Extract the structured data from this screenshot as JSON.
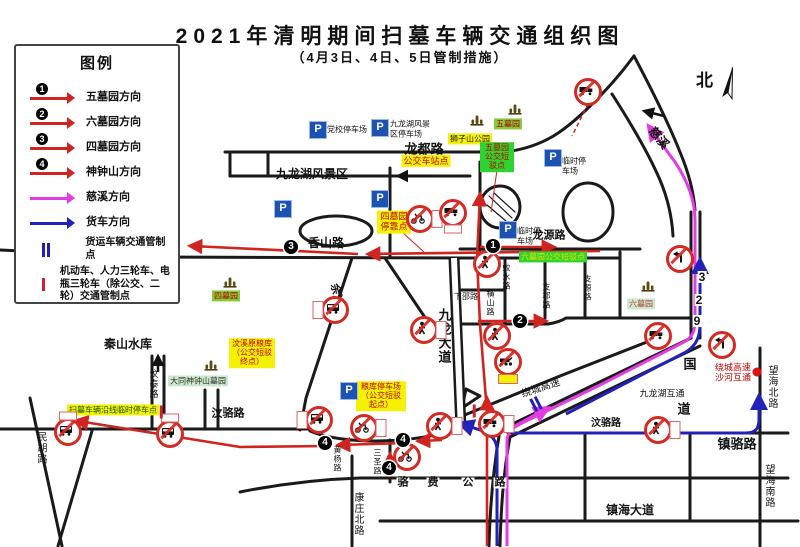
{
  "title": "2021年清明期间扫墓车辆交通组织图",
  "subtitle": "（4月3日、4日、5日管制措施）",
  "compass_label": "北",
  "colors": {
    "route_red": "#cf2420",
    "route_magenta": "#e23ce2",
    "route_blue": "#2222b8",
    "parking_blue": "#1c53b0",
    "highlight_yellow": "#f4f104",
    "highlight_green": "#2fd32f"
  },
  "legend": {
    "title": "图例",
    "routes": [
      {
        "num": "1",
        "label": "五墓园方向",
        "color": "#cf2420"
      },
      {
        "num": "2",
        "label": "六墓园方向",
        "color": "#cf2420"
      },
      {
        "num": "3",
        "label": "四墓园方向",
        "color": "#cf2420"
      },
      {
        "num": "4",
        "label": "神钟山方向",
        "color": "#cf2420"
      },
      {
        "num": "",
        "label": "慈溪方向",
        "color": "#e23ce2"
      },
      {
        "num": "",
        "label": "货车方向",
        "color": "#2222b8"
      }
    ],
    "points": [
      {
        "icon": "blue-double-bar",
        "label": "货运车辆交通管制点"
      },
      {
        "icon": "red-bar",
        "label": "机动车、人力三轮车、电瓶三轮车（除公交、二轮）交通管制点"
      }
    ]
  },
  "map": {
    "road_labels": [
      {
        "t": "龙都路",
        "x": 424,
        "y": 149,
        "s": 13,
        "b": 1
      },
      {
        "t": "九龙湖风景区",
        "x": 312,
        "y": 174,
        "s": 12,
        "b": 1
      },
      {
        "t": "香山路",
        "x": 326,
        "y": 243,
        "s": 12,
        "b": 1
      },
      {
        "t": "龙源路",
        "x": 549,
        "y": 236,
        "s": 11,
        "b": 1
      },
      {
        "t": "余汶线",
        "x": 337,
        "y": 300,
        "s": 11,
        "b": 1,
        "rot": 78
      },
      {
        "t": "九龙大道",
        "x": 444,
        "y": 336,
        "s": 13,
        "b": 1,
        "v": 1
      },
      {
        "t": "秦山水库",
        "x": 128,
        "y": 344,
        "s": 12,
        "b": 1
      },
      {
        "t": "汶泰路",
        "x": 153,
        "y": 384,
        "s": 9,
        "v": 1
      },
      {
        "t": "民胡路",
        "x": 40,
        "y": 448,
        "s": 10,
        "v": 1
      },
      {
        "t": "汶骆路",
        "x": 228,
        "y": 414,
        "s": 11,
        "b": 1
      },
      {
        "t": "汶骆路",
        "x": 606,
        "y": 424,
        "s": 10,
        "b": 1
      },
      {
        "t": "镇骆路",
        "x": 737,
        "y": 444,
        "s": 13,
        "b": 1
      },
      {
        "t": "望海北路",
        "x": 771,
        "y": 387,
        "s": 10,
        "v": 1
      },
      {
        "t": "望海南路",
        "x": 768,
        "y": 486,
        "s": 10,
        "v": 1
      },
      {
        "t": "镇海大道",
        "x": 630,
        "y": 510,
        "s": 12,
        "b": 1
      },
      {
        "t": "康庄北路",
        "x": 357,
        "y": 514,
        "s": 10,
        "v": 1
      },
      {
        "t": "绕城高速",
        "x": 541,
        "y": 389,
        "s": 10,
        "rot": -18
      },
      {
        "t": "九龙湖互通",
        "x": 662,
        "y": 394,
        "s": 9
      },
      {
        "t": "慈溪",
        "x": 659,
        "y": 138,
        "s": 12,
        "b": 1,
        "rot": 50
      },
      {
        "t": "下邵路",
        "x": 466,
        "y": 297,
        "s": 8
      },
      {
        "t": "蛟水路",
        "x": 506,
        "y": 277,
        "s": 8,
        "v": 1
      },
      {
        "t": "支源路",
        "x": 587,
        "y": 288,
        "s": 8,
        "v": 1
      },
      {
        "t": "支郡路",
        "x": 546,
        "y": 296,
        "s": 8,
        "v": 1
      },
      {
        "t": "横山路",
        "x": 490,
        "y": 303,
        "s": 8,
        "v": 1
      },
      {
        "t": "三圣路",
        "x": 377,
        "y": 462,
        "s": 8,
        "v": 1
      },
      {
        "t": "黄杨路",
        "x": 337,
        "y": 459,
        "s": 8,
        "v": 1
      },
      {
        "t": "3",
        "x": 702,
        "y": 277,
        "s": 12,
        "b": 1,
        "bg": 1
      },
      {
        "t": "2",
        "x": 699,
        "y": 300,
        "s": 12,
        "b": 1,
        "bg": 1
      },
      {
        "t": "9",
        "x": 697,
        "y": 321,
        "s": 12,
        "b": 1,
        "bg": 1
      },
      {
        "t": "国",
        "x": 690,
        "y": 364,
        "s": 13,
        "b": 1,
        "bg": 1
      },
      {
        "t": "道",
        "x": 684,
        "y": 409,
        "s": 13,
        "b": 1,
        "bg": 1
      },
      {
        "t": "骆",
        "x": 403,
        "y": 483,
        "s": 11,
        "b": 1,
        "bg": 1
      },
      {
        "t": "费",
        "x": 433,
        "y": 483,
        "s": 11,
        "b": 1,
        "bg": 1
      },
      {
        "t": "公",
        "x": 468,
        "y": 483,
        "s": 11,
        "b": 1,
        "bg": 1
      },
      {
        "t": "路",
        "x": 500,
        "y": 483,
        "s": 11,
        "b": 1,
        "bg": 1
      }
    ],
    "area_labels": [
      {
        "t": "公交车站点",
        "x": 426,
        "y": 161,
        "bg": "#f4f104",
        "c": "#c00000",
        "s": 9
      },
      {
        "t": "狮子山公园",
        "x": 470,
        "y": 139,
        "bg": "#f4f104",
        "c": "#222222",
        "s": 8
      },
      {
        "t": "五墓园",
        "x": 508,
        "y": 124,
        "bg": "#86cc3a",
        "c": "#b00000",
        "s": 8
      },
      {
        "t": "四墓园",
        "x": 226,
        "y": 296,
        "bg": "#86cc3a",
        "c": "#b00000",
        "s": 8
      },
      {
        "t": "六墓园",
        "x": 641,
        "y": 304,
        "bg": "#cde9cd",
        "c": "#b04040",
        "s": 8
      },
      {
        "t": "大同神钟山墓园",
        "x": 198,
        "y": 381,
        "bg": "#cde9cd",
        "c": "#333333",
        "s": 8
      },
      {
        "t": "五墓园公交短驳点",
        "x": 497,
        "y": 157,
        "bg": "#2fd32f",
        "c": "#c00000",
        "s": 8,
        "w": 30
      },
      {
        "t": "六墓园公交短驳点",
        "x": 553,
        "y": 257,
        "bg": "#2fd32f",
        "c": "#e8e000",
        "s": 8
      },
      {
        "t": "四墓园停靠点",
        "x": 394,
        "y": 222,
        "bg": "#f4f104",
        "c": "#c00000",
        "s": 9,
        "w": 30
      },
      {
        "t": "汶溪原粮库（公交短驳终点）",
        "x": 252,
        "y": 353,
        "bg": "#f4f104",
        "c": "#c00000",
        "s": 8,
        "w": 42
      },
      {
        "t": "粮库停车场（公交短驳起点）",
        "x": 381,
        "y": 396,
        "bg": "#f4f104",
        "c": "#c00000",
        "s": 8,
        "w": 46
      },
      {
        "t": "扫墓车辆沿线临时停车点",
        "x": 113,
        "y": 410,
        "bg": "#f4f104",
        "c": "#155515",
        "s": 8
      },
      {
        "t": "绕城高速沙河互通",
        "x": 733,
        "y": 373,
        "bg": "",
        "c": "#c00000",
        "s": 9,
        "w": 40
      }
    ],
    "parkings": [
      {
        "x": 318,
        "y": 130,
        "lt": "党校停车场",
        "lx": 352,
        "ly": 130,
        "lw": 50
      },
      {
        "x": 380,
        "y": 128,
        "lt": "九龙湖风景\n区停车场",
        "lx": 414,
        "ly": 129,
        "lw": 48
      },
      {
        "x": 380,
        "y": 199,
        "lt": "",
        "lx": 0,
        "ly": 0,
        "lw": 0
      },
      {
        "x": 283,
        "y": 209,
        "lt": "",
        "lx": 0,
        "ly": 0,
        "lw": 0
      },
      {
        "x": 508,
        "y": 230,
        "lt": "临时停\n车场",
        "lx": 530,
        "ly": 236,
        "lw": 26
      },
      {
        "x": 553,
        "y": 158,
        "lt": "临时停\n车场",
        "lx": 575,
        "ly": 166,
        "lw": 26
      },
      {
        "x": 349,
        "y": 391,
        "lt": "",
        "lx": 0,
        "ly": 0,
        "lw": 0
      }
    ],
    "pagodas": [
      {
        "x": 515,
        "y": 111
      },
      {
        "x": 477,
        "y": 122
      },
      {
        "x": 648,
        "y": 288
      },
      {
        "x": 230,
        "y": 284
      },
      {
        "x": 211,
        "y": 367
      }
    ],
    "signs": [
      {
        "x": 588,
        "y": 92,
        "g": "truck"
      },
      {
        "x": 680,
        "y": 259,
        "g": "turn"
      },
      {
        "x": 658,
        "y": 336,
        "g": "truck"
      },
      {
        "x": 722,
        "y": 345,
        "g": "turn"
      },
      {
        "x": 658,
        "y": 430,
        "g": "ped",
        "lab": "r"
      },
      {
        "x": 420,
        "y": 219,
        "g": "moto",
        "lab": "r"
      },
      {
        "x": 453,
        "y": 213,
        "g": "truck",
        "lab": "b"
      },
      {
        "x": 487,
        "y": 264,
        "g": "ped"
      },
      {
        "x": 497,
        "y": 336,
        "g": "ped"
      },
      {
        "x": 508,
        "y": 362,
        "g": "cart",
        "lab": "by"
      },
      {
        "x": 335,
        "y": 310,
        "g": "bus",
        "lab": "l"
      },
      {
        "x": 424,
        "y": 330,
        "g": "ped",
        "lab": "r"
      },
      {
        "x": 319,
        "y": 420,
        "g": "bus",
        "lab": "l"
      },
      {
        "x": 364,
        "y": 428,
        "g": "moto",
        "lab": "r"
      },
      {
        "x": 407,
        "y": 457,
        "g": "moto"
      },
      {
        "x": 440,
        "y": 426,
        "g": "ped",
        "lab": "r"
      },
      {
        "x": 492,
        "y": 424,
        "g": "truck",
        "lab": "r"
      },
      {
        "x": 68,
        "y": 432,
        "g": "bus",
        "lab": "t"
      },
      {
        "x": 170,
        "y": 434,
        "g": "bus",
        "lab": "t"
      }
    ],
    "route_markers": [
      {
        "n": "1",
        "x": 493,
        "y": 246
      },
      {
        "n": "2",
        "x": 520,
        "y": 321
      },
      {
        "n": "3",
        "x": 291,
        "y": 247
      },
      {
        "n": "4",
        "x": 325,
        "y": 443
      },
      {
        "n": "4",
        "x": 403,
        "y": 440
      },
      {
        "n": "4",
        "x": 389,
        "y": 468
      }
    ],
    "control_points": [
      {
        "type": "red-bar",
        "x": 161,
        "y": 412,
        "rot": 0
      },
      {
        "type": "red-bar",
        "x": 474,
        "y": 411,
        "rot": 0
      },
      {
        "type": "blue-double-bar",
        "x": 536,
        "y": 404,
        "rot": -27
      }
    ],
    "dots": [
      {
        "x": 757,
        "y": 372,
        "c": "#e01010"
      }
    ]
  }
}
